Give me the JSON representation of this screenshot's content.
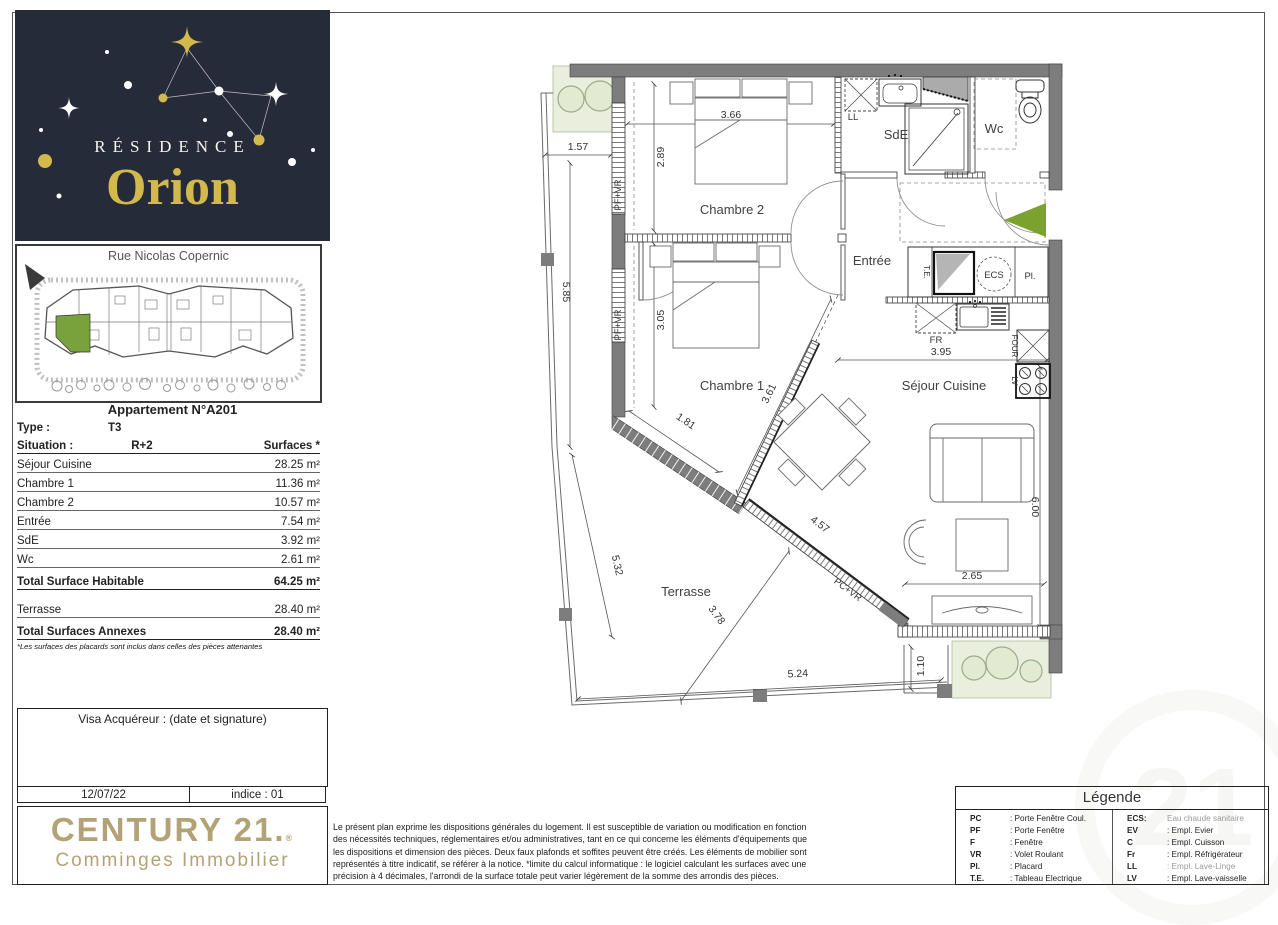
{
  "colors": {
    "logo_bg": "#252b38",
    "logo_gold": "#d3b94d",
    "century_gold": "#b4a277",
    "wall_gray": "#7d7d7d",
    "highlight_green": "#7aa23c",
    "planting_green": "#e9efdc"
  },
  "branding": {
    "residence_line1": "RÉSIDENCE",
    "residence_line2": "Orion",
    "agency_name": "CENTURY 21.",
    "agency_mark": "®",
    "agency_sub": "Comminges Immobilier"
  },
  "site_plan": {
    "street": "Rue Nicolas Copernic"
  },
  "apartment": {
    "title": "Appartement N°A201",
    "type_label": "Type :",
    "type_value": "T3",
    "situation_label": "Situation :",
    "situation_value": "R+2",
    "surfaces_header": "Surfaces *",
    "rooms": [
      {
        "label": "Séjour Cuisine",
        "value": "28.25 m²"
      },
      {
        "label": "Chambre 1",
        "value": "11.36 m²"
      },
      {
        "label": "Chambre 2",
        "value": "10.57 m²"
      },
      {
        "label": "Entrée",
        "value": "7.54 m²"
      },
      {
        "label": "SdE",
        "value": "3.92 m²"
      },
      {
        "label": "Wc",
        "value": "2.61 m²"
      }
    ],
    "total_habitable": {
      "label": "Total Surface Habitable",
      "value": "64.25 m²"
    },
    "annexe": {
      "label": "Terrasse",
      "value": "28.40 m²"
    },
    "total_annexes": {
      "label": "Total Surfaces Annexes",
      "value": "28.40 m²"
    },
    "footnote": "*Les surfaces des placards sont inclus dans celles des pièces attenantes"
  },
  "visa": {
    "title": "Visa Acquéreur : (date et signature)",
    "date": "12/07/22",
    "indice": "indice : 01"
  },
  "legal": {
    "text": "Le présent plan exprime les dispositions générales du logement. Il est susceptible de variation ou modification en fonction des nécessités techniques, réglementaires et/ou administratives, tant en ce qui concerne les éléments d'équipements que les dispositions et dimension des pièces. Deux faux plafonds et soffites peuvent être créés. Les éléments de mobilier sont représentés à titre indicatif, se référer à la notice. *limite du calcul informatique : le logiciel calculant les surfaces avec une précision à 4 décimales, l'arrondi de la surface totale peut varier légèrement de la somme des arrondis des pièces."
  },
  "legend": {
    "title": "Légende",
    "left": [
      {
        "abbr": "PC",
        "desc": ": Porte Fenêtre Coul."
      },
      {
        "abbr": "PF",
        "desc": ": Porte Fenêtre"
      },
      {
        "abbr": "F",
        "desc": ": Fenêtre"
      },
      {
        "abbr": "VR",
        "desc": ": Volet Roulant"
      },
      {
        "abbr": "Pl.",
        "desc": ": Placard"
      },
      {
        "abbr": "T.E.",
        "desc": ": Tableau Electrique"
      }
    ],
    "right": [
      {
        "abbr": "ECS:",
        "desc": "Eau chaude sanitaire"
      },
      {
        "abbr": "EV",
        "desc": ": Empl. Evier"
      },
      {
        "abbr": "C",
        "desc": ": Empl. Cuisson"
      },
      {
        "abbr": "Fr",
        "desc": ": Empl. Réfrigérateur"
      },
      {
        "abbr": "LL",
        "desc": ": Empl. Lave-Linge"
      },
      {
        "abbr": "LV",
        "desc": ": Empl. Lave-vaisselle"
      }
    ]
  },
  "plan": {
    "rooms": {
      "chambre2": "Chambre 2",
      "chambre1": "Chambre 1",
      "sde": "SdE",
      "wc": "Wc",
      "entree": "Entrée",
      "sejour": "Séjour Cuisine",
      "terrasse": "Terrasse"
    },
    "labels": {
      "ll": "LL",
      "te": "T.E.",
      "ecs": "ECS",
      "pl": "Pl.",
      "fr": "FR",
      "four": "FOUR",
      "lv": "LV",
      "pfvr": "PF+VR",
      "pcvr": "PC+VR",
      "north": "N"
    },
    "dims": {
      "d157": "1.57",
      "d585": "5.85",
      "d532": "5.32",
      "d289": "2.89",
      "d305": "3.05",
      "d366": "3.66",
      "d395": "3.95",
      "d600": "6.00",
      "d265": "2.65",
      "d361": "3.61",
      "d181": "1.81",
      "d457": "4.57",
      "d524": "5.24",
      "d378": "3.78",
      "d110": "1.10"
    }
  }
}
